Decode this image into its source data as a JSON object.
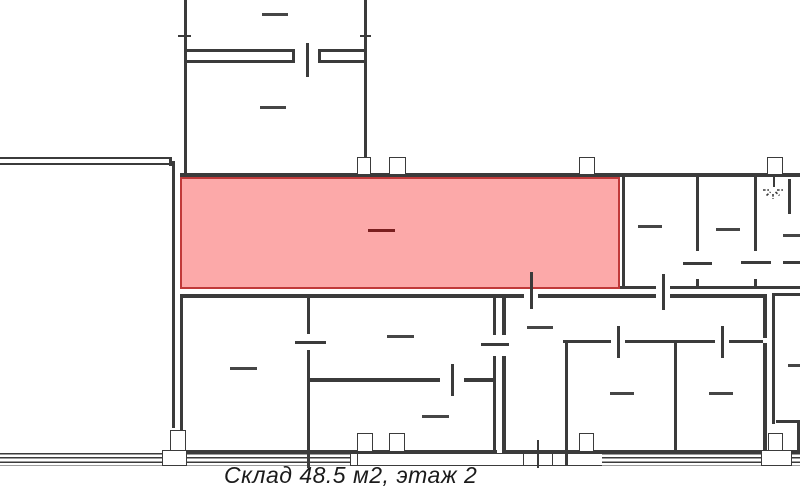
{
  "caption": {
    "text": "Склад 48.5 м2, этаж 2"
  },
  "colors": {
    "background": "#ffffff",
    "wall": "#3b3b3b",
    "dash": "#464646",
    "highlight_fill": "#fca9a9",
    "highlight_border": "#c03a3a",
    "highlight_dash": "#7a1f1f",
    "caption_text": "#1b1b1b"
  },
  "canvas": {
    "width": 800,
    "height": 497
  },
  "highlight_room": {
    "x": 180,
    "y": 177,
    "width": 440,
    "height": 112,
    "dash": [
      366,
      227,
      27
    ]
  },
  "lamp": {
    "x": 762,
    "y": 183,
    "width": 22,
    "height": 18
  },
  "geometry": {
    "walls": [
      [
        184,
        0,
        3,
        175
      ],
      [
        364,
        0,
        3,
        175
      ],
      [
        186,
        49,
        106,
        2.5
      ],
      [
        320,
        49,
        46,
        2.5
      ],
      [
        186,
        60,
        106,
        3
      ],
      [
        320,
        60,
        46,
        3
      ],
      [
        292,
        49,
        2.5,
        14
      ],
      [
        318,
        49,
        2.5,
        14
      ],
      [
        178,
        35,
        13,
        2
      ],
      [
        360,
        35,
        11,
        2
      ],
      [
        0,
        157,
        172,
        2
      ],
      [
        0,
        163,
        169,
        2
      ],
      [
        169,
        157,
        3,
        9
      ],
      [
        172,
        161,
        3,
        267
      ],
      [
        180,
        173,
        620,
        4
      ],
      [
        622,
        177,
        3,
        111
      ],
      [
        696,
        177,
        3,
        74
      ],
      [
        696,
        279,
        3,
        9
      ],
      [
        754,
        177,
        3,
        74
      ],
      [
        754,
        279,
        3,
        9
      ],
      [
        788,
        179,
        3,
        35
      ],
      [
        620,
        286,
        36,
        3
      ],
      [
        670,
        286,
        130,
        3
      ],
      [
        180,
        294,
        344,
        3.5
      ],
      [
        538,
        294,
        118,
        3.5
      ],
      [
        670,
        294,
        93,
        3.5
      ],
      [
        772,
        293,
        28,
        3
      ],
      [
        180,
        294,
        3,
        159
      ],
      [
        307,
        294,
        3,
        40
      ],
      [
        307,
        350,
        3,
        103
      ],
      [
        493,
        294,
        3,
        41
      ],
      [
        493,
        356,
        3,
        97
      ],
      [
        502,
        294,
        3.5,
        41
      ],
      [
        502,
        356,
        3.5,
        97
      ],
      [
        763,
        294,
        3.5,
        44
      ],
      [
        763,
        343,
        3.5,
        110
      ],
      [
        772,
        294,
        3,
        130
      ],
      [
        797,
        423,
        3,
        30
      ],
      [
        776,
        420,
        24,
        3
      ],
      [
        310,
        378,
        130,
        3.5
      ],
      [
        464,
        378,
        32,
        3.5
      ],
      [
        563,
        340,
        48,
        3
      ],
      [
        625,
        340,
        90,
        3
      ],
      [
        729,
        340,
        34,
        3
      ],
      [
        565,
        343,
        3,
        110
      ],
      [
        674,
        343,
        3,
        110
      ],
      [
        180,
        450,
        317,
        3
      ],
      [
        502,
        450,
        261,
        3
      ],
      [
        776,
        450,
        24,
        3
      ],
      [
        307,
        453,
        2.5,
        15
      ],
      [
        565,
        453,
        3,
        13
      ]
    ],
    "door_marks": [
      [
        306,
        43,
        2.5,
        34
      ],
      [
        530,
        272,
        2.5,
        37
      ],
      [
        662,
        274,
        2.5,
        36
      ],
      [
        617,
        326,
        2.5,
        32
      ],
      [
        721,
        326,
        2.5,
        32
      ],
      [
        451,
        364,
        2.5,
        32
      ],
      [
        537,
        440,
        2,
        28
      ],
      [
        295,
        341,
        31,
        2.5
      ],
      [
        481,
        343,
        28,
        2.5
      ],
      [
        683,
        262,
        29,
        2.5
      ],
      [
        741,
        261,
        30,
        2.5
      ],
      [
        783,
        261,
        17,
        2.5
      ],
      [
        773,
        177,
        2,
        10
      ]
    ],
    "columns": [
      [
        357,
        157,
        14,
        18
      ],
      [
        389,
        157,
        17,
        18
      ],
      [
        579,
        157,
        16,
        18
      ],
      [
        767,
        157,
        16,
        18
      ],
      [
        170,
        430,
        16,
        22
      ],
      [
        162,
        450,
        25,
        16
      ],
      [
        357,
        433,
        16,
        19
      ],
      [
        389,
        433,
        16,
        19
      ],
      [
        579,
        433,
        15,
        19
      ],
      [
        768,
        433,
        15,
        18
      ],
      [
        523,
        453,
        30,
        13
      ],
      [
        350,
        453,
        8,
        13
      ],
      [
        761,
        450,
        31,
        16
      ]
    ],
    "bands_striped": [
      [
        0,
        453,
        162,
        13
      ],
      [
        186,
        453,
        164,
        13
      ],
      [
        602,
        453,
        160,
        13
      ],
      [
        792,
        453,
        8,
        13
      ]
    ],
    "bands_plain": [
      [
        357,
        453,
        166,
        13
      ],
      [
        553,
        453,
        49,
        13
      ]
    ],
    "dashes": [
      [
        262,
        13,
        26
      ],
      [
        260,
        106,
        26
      ],
      [
        638,
        225,
        24
      ],
      [
        716,
        228,
        24
      ],
      [
        783,
        234,
        17
      ],
      [
        230,
        367,
        27
      ],
      [
        387,
        335,
        27
      ],
      [
        422,
        415,
        27
      ],
      [
        527,
        326,
        26
      ],
      [
        610,
        392,
        24
      ],
      [
        709,
        392,
        24
      ],
      [
        788,
        364,
        12
      ]
    ]
  }
}
